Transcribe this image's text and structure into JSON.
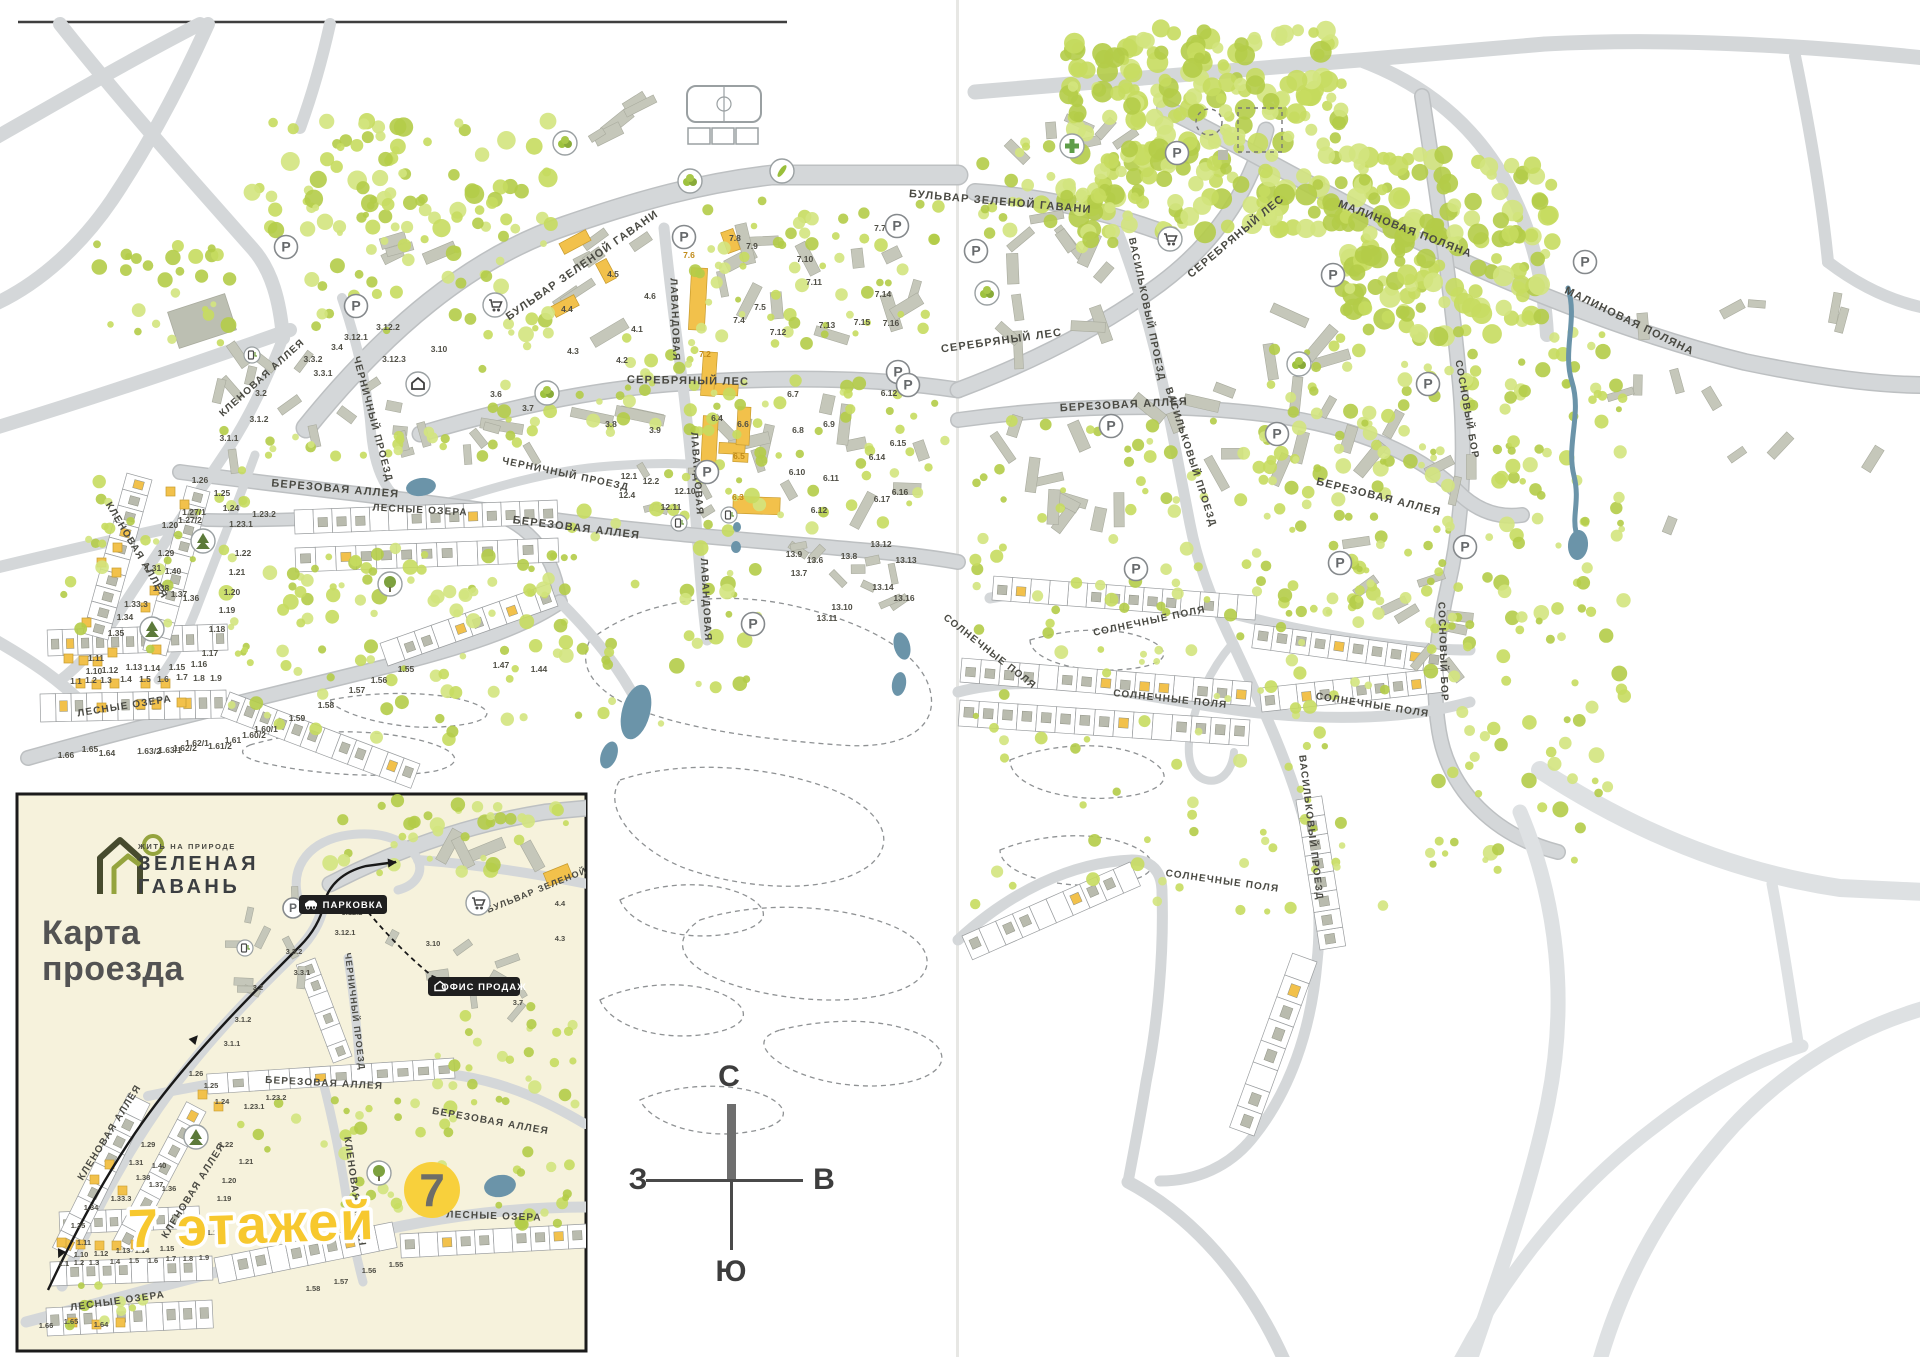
{
  "meta": {
    "map_title": "Генплан ЖК Зеленая Гавань"
  },
  "colors": {
    "road": "#d4d7d9",
    "road_casing": "#bdc0c2",
    "road_light": "#dee1e3",
    "green": "#c6db5f",
    "green2": "#b4cc48",
    "green3": "#d3e47e",
    "building": "#c5c7ba",
    "building_stroke": "#a9ab9e",
    "yellow_building": "#f2c14b",
    "water": "#6b94a9",
    "ink": "#4a4a43",
    "orange_num": "#c08a18",
    "cream": "#f6f2dc",
    "accent_yellow": "#f7c82e"
  },
  "inset": {
    "tagline": "ЖИТЬ НА ПРИРОДЕ",
    "brand1": "ЗЕЛЕНАЯ",
    "brand2": "ГАВАНЬ",
    "title1": "Карта",
    "title2": "проезда",
    "floors": "7 этажей",
    "badge7": "7",
    "parking": "ПАРКОВКА",
    "office": "ОФИС ПРОДАЖ"
  },
  "compass": {
    "n": "С",
    "e": "В",
    "s": "Ю",
    "w": "З"
  },
  "parking_letter": "Р",
  "streets": [
    [
      "БУЛЬВАР ЗЕЛЕНОЙ ГАВАНИ",
      584,
      268,
      -35,
      11,
      0
    ],
    [
      "БУЛЬВАР ЗЕЛЕНОЙ ГАВАНИ",
      1000,
      205,
      5,
      11,
      0
    ],
    [
      "СЕРЕБРЯНЫЙ ЛЕС",
      688,
      384,
      1,
      11,
      0
    ],
    [
      "СЕРЕБРЯНЫЙ ЛЕС",
      1002,
      344,
      -8,
      11,
      0
    ],
    [
      "СЕРЕБРЯНЫЙ ЛЕС",
      1238,
      239,
      -40,
      11,
      0
    ],
    [
      "ЛАВАНДОВАЯ",
      672,
      320,
      88,
      10,
      0
    ],
    [
      "ЛАВАНДОВАЯ",
      694,
      474,
      86,
      10,
      0
    ],
    [
      "ЛАВАНДОВАЯ",
      703,
      600,
      87,
      10,
      0
    ],
    [
      "ЧЕРНИЧНЫЙ ПРОЕЗД",
      370,
      420,
      75,
      10,
      0
    ],
    [
      "ЧЕРНИЧНЫЙ ПРОЕЗД",
      565,
      477,
      12,
      10,
      0
    ],
    [
      "БЕРЕЗОВАЯ АЛЛЕЯ",
      335,
      492,
      5,
      11,
      0
    ],
    [
      "БЕРЕЗОВАЯ АЛЛЕЯ",
      576,
      531,
      7,
      11,
      0
    ],
    [
      "БЕРЕЗОВАЯ АЛЛЕЯ",
      1124,
      408,
      -3,
      11,
      0
    ],
    [
      "БЕРЕЗОВАЯ АЛЛЕЯ",
      1378,
      500,
      14,
      11,
      0
    ],
    [
      "КЛЕНОВАЯ АЛЛЕЯ",
      264,
      380,
      -42,
      10,
      0
    ],
    [
      "КЛЕНОВАЯ АЛЛЕЯ",
      134,
      552,
      59,
      10,
      0
    ],
    [
      "ЛЕСНЫЕ ОЗЕРА",
      420,
      513,
      3,
      10,
      0
    ],
    [
      "ЛЕСНЫЕ ОЗЕРА",
      125,
      709,
      -9,
      10,
      0
    ],
    [
      "МАЛИНОВАЯ ПОЛЯНА",
      1404,
      232,
      21,
      11,
      0
    ],
    [
      "МАЛИНОВАЯ ПОЛЯНА",
      1628,
      324,
      26,
      11,
      0
    ],
    [
      "ВАСИЛЬКОВЫЙ ПРОЕЗД",
      1144,
      310,
      78,
      10,
      0
    ],
    [
      "ВАСИЛЬКОВЫЙ ПРОЕЗД",
      1188,
      458,
      72,
      10,
      0
    ],
    [
      "ВАСИЛЬКОВЫЙ ПРОЕЗД",
      1308,
      828,
      83,
      10,
      0
    ],
    [
      "СОСНОВЫЙ БОР",
      1464,
      410,
      80,
      10,
      0
    ],
    [
      "СОСНОВЫЙ БОР",
      1440,
      652,
      88,
      10,
      0
    ],
    [
      "СОЛНЕЧНЫЕ ПОЛЯ",
      1150,
      624,
      -12,
      10,
      0
    ],
    [
      "СОЛНЕЧНЫЕ ПОЛЯ",
      988,
      654,
      38,
      10,
      0
    ],
    [
      "СОЛНЕЧНЫЕ ПОЛЯ",
      1170,
      702,
      6,
      10,
      0
    ],
    [
      "СОЛНЕЧНЫЕ ПОЛЯ",
      1372,
      708,
      9,
      10,
      0
    ],
    [
      "СОЛНЕЧНЫЕ ПОЛЯ",
      1222,
      884,
      8,
      10,
      0
    ],
    [
      "КЛЕНОВАЯ АЛЛЕЯ",
      112,
      1134,
      -58,
      10,
      1
    ],
    [
      "КЛЕНОВАЯ АЛЛЕЯ",
      196,
      1192,
      -58,
      10,
      1
    ],
    [
      "КЛЕНОВАЯ АЛЛЕЯ",
      352,
      1192,
      82,
      10,
      1
    ],
    [
      "БЕРЕЗОВАЯ АЛЛЕЯ",
      324,
      1086,
      3,
      10,
      1
    ],
    [
      "БЕРЕЗОВАЯ АЛЛЕЯ",
      490,
      1124,
      10,
      10,
      1
    ],
    [
      "ЧЕРНИЧНЫЙ ПРОЕЗД",
      352,
      1012,
      83,
      9,
      1
    ],
    [
      "ЛЕСНЫЕ ОЗЕРА",
      118,
      1304,
      -8,
      10,
      1
    ],
    [
      "ЛЕСНЫЕ ОЗЕРА",
      494,
      1219,
      2,
      10,
      1
    ],
    [
      "БУЛЬВАР ЗЕЛЕНОЙ ГАВАНИ",
      560,
      884,
      -22,
      9,
      1
    ]
  ],
  "numbers": [
    [
      "4.1",
      637,
      332,
      0
    ],
    [
      "4.2",
      622,
      363,
      0
    ],
    [
      "4.3",
      573,
      354,
      0
    ],
    [
      "4.4",
      567,
      312,
      0
    ],
    [
      "4.5",
      613,
      277,
      0
    ],
    [
      "4.6",
      650,
      299,
      0
    ],
    [
      "7.2",
      705,
      357,
      1
    ],
    [
      "7.4",
      739,
      323,
      0
    ],
    [
      "7.5",
      760,
      310,
      0
    ],
    [
      "7.6",
      689,
      258,
      1
    ],
    [
      "7.7",
      880,
      231,
      0
    ],
    [
      "7.8",
      735,
      241,
      0
    ],
    [
      "7.9",
      752,
      249,
      0
    ],
    [
      "7.10",
      805,
      262,
      0
    ],
    [
      "7.11",
      814,
      285,
      0
    ],
    [
      "7.12",
      778,
      335,
      0
    ],
    [
      "7.13",
      827,
      328,
      0
    ],
    [
      "7.14",
      883,
      297,
      0
    ],
    [
      "7.15",
      862,
      325,
      0
    ],
    [
      "7.16",
      891,
      326,
      0
    ],
    [
      "3.1.1",
      229,
      441,
      0
    ],
    [
      "3.1.2",
      259,
      422,
      0
    ],
    [
      "3.2",
      261,
      396,
      0
    ],
    [
      "3.3.1",
      323,
      376,
      0
    ],
    [
      "3.3.2",
      313,
      362,
      0
    ],
    [
      "3.4",
      337,
      350,
      0
    ],
    [
      "3.6",
      496,
      397,
      0
    ],
    [
      "3.7",
      528,
      411,
      0
    ],
    [
      "3.8",
      611,
      427,
      0
    ],
    [
      "3.9",
      655,
      433,
      0
    ],
    [
      "3.10",
      439,
      352,
      0
    ],
    [
      "3.12.1",
      356,
      340,
      0
    ],
    [
      "3.12.2",
      388,
      330,
      0
    ],
    [
      "3.12.3",
      394,
      362,
      0
    ],
    [
      "6.3",
      738,
      500,
      1
    ],
    [
      "6.4",
      717,
      421,
      0
    ],
    [
      "6.5",
      739,
      459,
      1
    ],
    [
      "6.6",
      743,
      427,
      0
    ],
    [
      "6.7",
      793,
      397,
      0
    ],
    [
      "6.8",
      798,
      433,
      0
    ],
    [
      "6.9",
      829,
      427,
      0
    ],
    [
      "6.10",
      797,
      475,
      0
    ],
    [
      "6.11",
      831,
      481,
      0
    ],
    [
      "6.12",
      889,
      396,
      0
    ],
    [
      "6.12",
      819,
      513,
      0
    ],
    [
      "6.14",
      877,
      460,
      0
    ],
    [
      "6.15",
      898,
      446,
      0
    ],
    [
      "6.16",
      900,
      495,
      0
    ],
    [
      "6.17",
      882,
      502,
      0
    ],
    [
      "13.6",
      815,
      563,
      0
    ],
    [
      "13.7",
      799,
      576,
      0
    ],
    [
      "13.8",
      849,
      559,
      0
    ],
    [
      "13.9",
      794,
      557,
      0
    ],
    [
      "13.10",
      842,
      610,
      0
    ],
    [
      "13.11",
      827,
      621,
      0
    ],
    [
      "13.12",
      881,
      547,
      0
    ],
    [
      "13.13",
      906,
      563,
      0
    ],
    [
      "13.14",
      883,
      590,
      0
    ],
    [
      "13.16",
      904,
      601,
      0
    ],
    [
      "12.1",
      629,
      479,
      0
    ],
    [
      "12.2",
      651,
      484,
      0
    ],
    [
      "12.4",
      627,
      498,
      0
    ],
    [
      "12.10",
      685,
      494,
      0
    ],
    [
      "12.11",
      671,
      510,
      0
    ],
    [
      "1.26",
      200,
      483,
      0
    ],
    [
      "1.25",
      222,
      496,
      0
    ],
    [
      "1.24",
      231,
      511,
      0
    ],
    [
      "1.27/1",
      194,
      515,
      0
    ],
    [
      "1.27/2",
      190,
      523,
      0
    ],
    [
      "1.20",
      170,
      528,
      0
    ],
    [
      "1.23.2",
      264,
      517,
      0
    ],
    [
      "1.23.1",
      241,
      527,
      0
    ],
    [
      "1.29",
      166,
      556,
      0
    ],
    [
      "1.31",
      153,
      571,
      0
    ],
    [
      "1.40",
      173,
      574,
      0
    ],
    [
      "1.38",
      161,
      591,
      0
    ],
    [
      "1.37",
      179,
      597,
      0
    ],
    [
      "1.36",
      191,
      601,
      0
    ],
    [
      "1.33.3",
      136,
      607,
      0
    ],
    [
      "1.34",
      125,
      620,
      0
    ],
    [
      "1.35",
      116,
      636,
      0
    ],
    [
      "1.22",
      243,
      556,
      0
    ],
    [
      "1.21",
      237,
      575,
      0
    ],
    [
      "1.20",
      232,
      595,
      0
    ],
    [
      "1.19",
      227,
      613,
      0
    ],
    [
      "1.18",
      217,
      632,
      0
    ],
    [
      "1.17",
      210,
      656,
      0
    ],
    [
      "1.11",
      96,
      661,
      0
    ],
    [
      "1.10",
      94,
      674,
      0
    ],
    [
      "1.12",
      110,
      673,
      0
    ],
    [
      "1.13",
      134,
      670,
      0
    ],
    [
      "1.14",
      152,
      671,
      0
    ],
    [
      "1.15",
      177,
      670,
      0
    ],
    [
      "1.16",
      199,
      667,
      0
    ],
    [
      "1.1",
      76,
      684,
      0
    ],
    [
      "1.2",
      91,
      683,
      0
    ],
    [
      "1.3",
      106,
      683,
      0
    ],
    [
      "1.4",
      126,
      682,
      0
    ],
    [
      "1.5",
      145,
      682,
      0
    ],
    [
      "1.6",
      163,
      682,
      0
    ],
    [
      "1.7",
      182,
      680,
      0
    ],
    [
      "1.8",
      199,
      681,
      0
    ],
    [
      "1.9",
      216,
      681,
      0
    ],
    [
      "1.47",
      501,
      668,
      0
    ],
    [
      "1.44",
      539,
      672,
      0
    ],
    [
      "1.55",
      406,
      672,
      0
    ],
    [
      "1.56",
      379,
      683,
      0
    ],
    [
      "1.57",
      357,
      693,
      0
    ],
    [
      "1.58",
      326,
      708,
      0
    ],
    [
      "1.59",
      297,
      721,
      0
    ],
    [
      "1.60/1",
      266,
      732,
      0
    ],
    [
      "1.60/2",
      254,
      738,
      0
    ],
    [
      "1.61",
      233,
      743,
      0
    ],
    [
      "1.61/2",
      220,
      749,
      0
    ],
    [
      "1.62/1",
      197,
      746,
      0
    ],
    [
      "1.62/2",
      185,
      751,
      0
    ],
    [
      "1.63/1",
      170,
      753,
      0
    ],
    [
      "1.63/2",
      149,
      754,
      0
    ],
    [
      "1.64",
      107,
      756,
      0
    ],
    [
      "1.65",
      90,
      752,
      0
    ],
    [
      "1.66",
      66,
      758,
      0
    ]
  ],
  "inset_numbers": [
    [
      "3.10",
      433,
      946
    ],
    [
      "3.7",
      518,
      1005
    ],
    [
      "4.4",
      560,
      906
    ],
    [
      "4.3",
      560,
      941
    ],
    [
      "3.12.1",
      345,
      935
    ],
    [
      "3.12.2",
      352,
      915
    ],
    [
      "3.3.2",
      294,
      954
    ],
    [
      "3.3.1",
      302,
      975
    ],
    [
      "3.2",
      258,
      990
    ],
    [
      "3.1.2",
      243,
      1022
    ],
    [
      "3.1.1",
      232,
      1046
    ],
    [
      "1.26",
      196,
      1076
    ],
    [
      "1.25",
      211,
      1088
    ],
    [
      "1.24",
      222,
      1104
    ],
    [
      "1.23.1",
      254,
      1109
    ],
    [
      "1.23.2",
      276,
      1100
    ],
    [
      "1.22",
      226,
      1147
    ],
    [
      "1.21",
      246,
      1164
    ],
    [
      "1.20",
      229,
      1183
    ],
    [
      "1.19",
      224,
      1201
    ],
    [
      "1.29",
      148,
      1147
    ],
    [
      "1.31",
      136,
      1165
    ],
    [
      "1.40",
      159,
      1168
    ],
    [
      "1.38",
      143,
      1180
    ],
    [
      "1.37",
      156,
      1187
    ],
    [
      "1.36",
      169,
      1191
    ],
    [
      "1.33.3",
      121,
      1201
    ],
    [
      "1.34",
      91,
      1210
    ],
    [
      "1.35",
      78,
      1228
    ],
    [
      "1.30",
      228,
      1222
    ],
    [
      "1.17",
      214,
      1235
    ],
    [
      "1.11",
      84,
      1245
    ],
    [
      "1.10",
      81,
      1257
    ],
    [
      "1.12",
      101,
      1256
    ],
    [
      "1.13",
      123,
      1253
    ],
    [
      "1.14",
      142,
      1253
    ],
    [
      "1.15",
      167,
      1251
    ],
    [
      "1.16",
      189,
      1248
    ],
    [
      "1.1",
      64,
      1266
    ],
    [
      "1.2",
      79,
      1265
    ],
    [
      "1.3",
      94,
      1265
    ],
    [
      "1.4",
      115,
      1264
    ],
    [
      "1.5",
      134,
      1263
    ],
    [
      "1.6",
      153,
      1263
    ],
    [
      "1.7",
      171,
      1261
    ],
    [
      "1.8",
      188,
      1261
    ],
    [
      "1.9",
      204,
      1260
    ],
    [
      "1.55",
      396,
      1267
    ],
    [
      "1.56",
      369,
      1273
    ],
    [
      "1.57",
      341,
      1284
    ],
    [
      "1.58",
      313,
      1291
    ],
    [
      "1.64",
      101,
      1327
    ],
    [
      "1.65",
      71,
      1324
    ],
    [
      "1.66",
      46,
      1328
    ]
  ],
  "parkings": [
    [
      286,
      247,
      0
    ],
    [
      356,
      306,
      0
    ],
    [
      684,
      237,
      0
    ],
    [
      897,
      226,
      0
    ],
    [
      898,
      372,
      0
    ],
    [
      707,
      472,
      0
    ],
    [
      753,
      624,
      0
    ],
    [
      976,
      251,
      0
    ],
    [
      1177,
      153,
      0
    ],
    [
      908,
      385,
      0
    ],
    [
      1333,
      275,
      0
    ],
    [
      1585,
      262,
      0
    ],
    [
      1111,
      426,
      0
    ],
    [
      1277,
      434,
      0
    ],
    [
      1428,
      384,
      0
    ],
    [
      1136,
      569,
      0
    ],
    [
      1340,
      563,
      0
    ],
    [
      1465,
      547,
      0
    ],
    [
      293,
      908,
      1
    ]
  ],
  "amenities": [
    [
      "cross",
      1072,
      146,
      0
    ],
    [
      "cart",
      495,
      305,
      0
    ],
    [
      "cart",
      1170,
      239,
      0
    ],
    [
      "cart",
      478,
      903,
      1
    ],
    [
      "bush",
      565,
      143,
      0
    ],
    [
      "bush",
      690,
      181,
      0
    ],
    [
      "bush",
      987,
      293,
      0
    ],
    [
      "bush",
      547,
      393,
      0
    ],
    [
      "bush",
      1299,
      364,
      0
    ],
    [
      "leaf",
      782,
      171,
      0
    ],
    [
      "pinec",
      203,
      541,
      0
    ],
    [
      "pinec",
      152,
      629,
      0
    ],
    [
      "pinec",
      196,
      1137,
      1
    ],
    [
      "tree",
      390,
      584,
      0
    ],
    [
      "tree",
      379,
      1173,
      1
    ],
    [
      "ev",
      252,
      355,
      0
    ],
    [
      "ev",
      245,
      948,
      1
    ],
    [
      "ev",
      679,
      523,
      0
    ],
    [
      "ev",
      729,
      515,
      0
    ],
    [
      "house",
      418,
      384,
      0
    ]
  ]
}
